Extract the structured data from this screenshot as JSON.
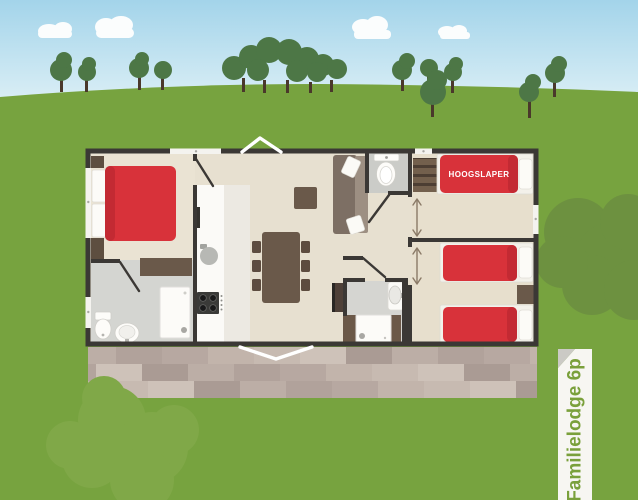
{
  "illustration": {
    "type": "lodge-floorplan-scene",
    "labels": {
      "bunk_bed": "HOOGSLAPER",
      "ribbon": "Familielodge 6p"
    },
    "colors": {
      "sky_top": "#a3d4ea",
      "sky_bottom": "#eaf6f9",
      "cloud": "#fbfdfd",
      "grass": "#77a33f",
      "tree": "#4d7746",
      "trunk": "#4a382b",
      "bush_light": "#80a848",
      "bush_dark": "#6d9140",
      "wall": "#3b3835",
      "floor_living": "#e7e0d0",
      "floor_master": "#eae3d3",
      "floor_bedroom": "#e7dfcd",
      "floor_bath": "#d4d5d1",
      "floor_wc": "#cbccc8",
      "counter_white": "#fbfaf7",
      "bed_red": "#d8323a",
      "bed_red_dark": "#c32a33",
      "furniture_brown": "#6a594a",
      "furniture_dark_brown": "#5d4e40",
      "sofa": "#7d6f64",
      "sofa_seat": "#9d8f82",
      "arrow": "#8a7a67",
      "window_white": "#f4f3ef",
      "ribbon_bg": "#f7f6f2",
      "ribbon_fold": "#cbcac5",
      "ribbon_text": "#7aa03b"
    },
    "terrace_palette": [
      "#bcaea6",
      "#c7bab1",
      "#b1a29b",
      "#cec2b9",
      "#b7a8a1",
      "#aa9b94",
      "#c2b4ab"
    ]
  }
}
